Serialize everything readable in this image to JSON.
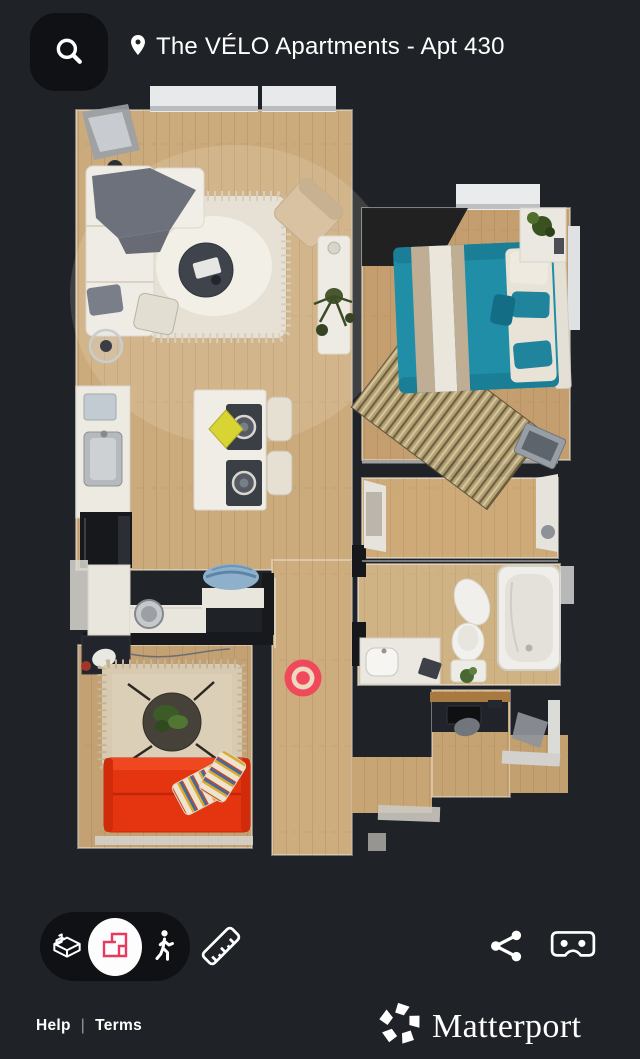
{
  "header": {
    "title": "The VÉLO Apartments - Apt 430"
  },
  "toolbar": {
    "active_mode": "floorplan",
    "modes": [
      {
        "id": "dollhouse",
        "icon": "dollhouse-3d-icon"
      },
      {
        "id": "floorplan",
        "icon": "floorplan-icon"
      },
      {
        "id": "walk",
        "icon": "person-walking-icon"
      }
    ],
    "measure_icon": "ruler-icon",
    "share_icon": "share-nodes-icon",
    "vr_icon": "vr-headset-icon"
  },
  "header_icons": {
    "search": "magnifier-icon",
    "location": "map-pin-icon"
  },
  "footer": {
    "help": "Help",
    "divider": "|",
    "terms": "Terms",
    "brand": "Matterport",
    "brand_icon": "matterport-pinwheel-icon"
  },
  "floorplan": {
    "view": "top-down-floorplan",
    "marker_transform": "translate(303,678)"
  },
  "colors": {
    "background": "#1f2226",
    "surface": "#0f1114",
    "accent_pink": "#e83a5f",
    "marker_red": "#f0495c",
    "wood_floor": "#cbaa7c",
    "bed_teal": "#1f8ea6",
    "sofa_red": "#e53410",
    "text": "#ffffff"
  }
}
